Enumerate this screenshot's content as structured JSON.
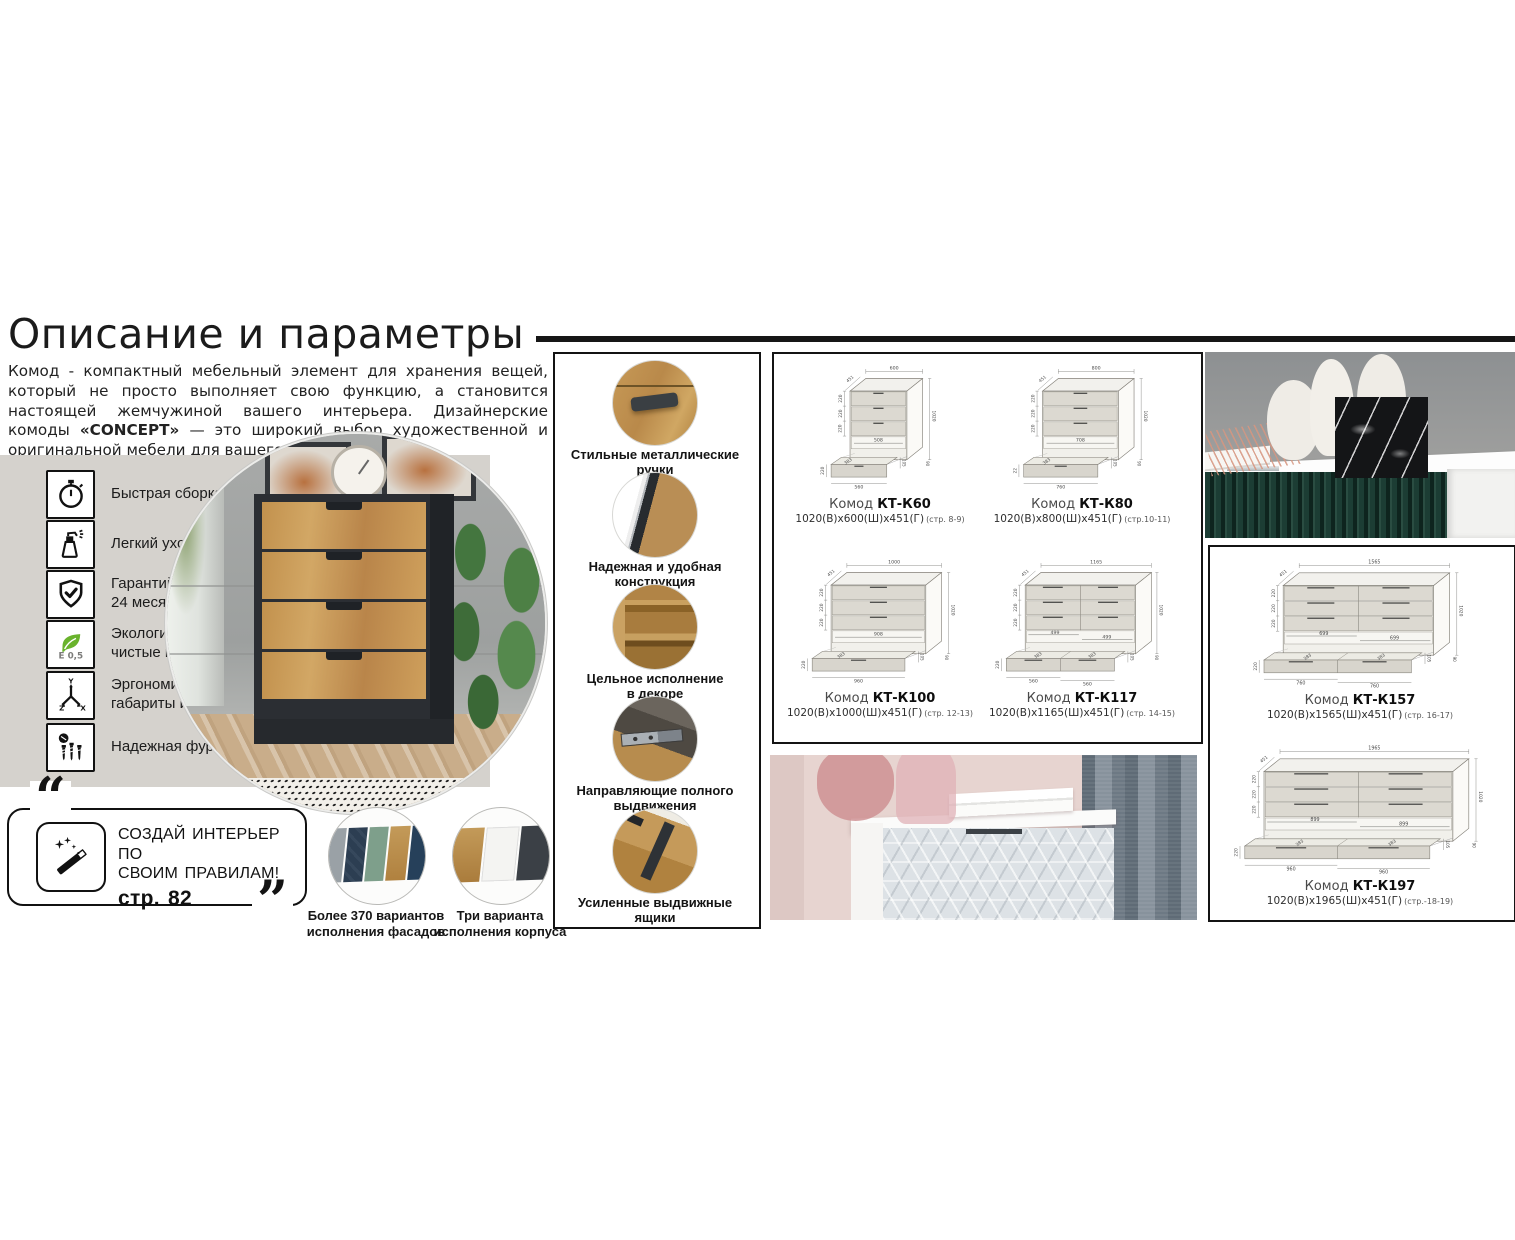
{
  "page": {
    "title": "Описание и параметры"
  },
  "intro": {
    "part1": "Комод - компактный мебельный элемент для хранения вещей, который не просто выполняет свою функцию, а становится настоящей жемчужиной вашего интерьера. Дизайнерские комоды ",
    "brand": "«CONCEPT»",
    "part2": " — это широкий выбор художественной и оригинальной мебели для вашего пространства."
  },
  "features": [
    {
      "icon": "stopwatch-icon",
      "line1": "Быстрая сборка",
      "line2": ""
    },
    {
      "icon": "spray-bottle-icon",
      "line1": "Легкий уход",
      "line2": ""
    },
    {
      "icon": "shield-check-icon",
      "line1": "Гарантийный срок",
      "line2": "24 месяца"
    },
    {
      "icon": "eco-leaf-icon",
      "icon_text": "E 0,5",
      "line1": "Экологически",
      "line2": "чистые материалы"
    },
    {
      "icon": "dimensions-axes-icon",
      "line1": "Эргономичные",
      "line2": "габариты изделий"
    },
    {
      "icon": "hardware-screws-icon",
      "line1": "Надежная фурнитура",
      "line2": ""
    }
  ],
  "promo": {
    "quote_open": "“",
    "quote_close": "”",
    "line1": "СОЗДАЙ ИНТЕРЬЕР ПО",
    "line2": "СВОИМ ПРАВИЛАМ!",
    "page_ref": "стр. 82"
  },
  "variants": [
    {
      "line1": "Более 370 вариантов",
      "line2": "исполнения фасадов",
      "colors": [
        "#9aa1a6",
        "#2c3e52",
        "#7e9f8b",
        "#b98d4f",
        "#26405a"
      ]
    },
    {
      "line1": "Три варианта",
      "line2": "исполнения корпуса",
      "colors": [
        "#bb8e4e",
        "#f4f4f2",
        "#3b4046"
      ]
    }
  ],
  "details": [
    {
      "line1": "Стильные металлические",
      "line2": "ручки"
    },
    {
      "line1": "Надежная и удобная",
      "line2": "конструкция"
    },
    {
      "line1": "Цельное исполнение",
      "line2": "в декоре"
    },
    {
      "line1": "Направляющие полного",
      "line2": "выдвижения"
    },
    {
      "line1": "Усиленные выдвижные",
      "line2": "ящики"
    }
  ],
  "drawings": {
    "items": [
      {
        "name_prefix": "Комод",
        "model": "КТ-К60",
        "dims": "1020(В)х600(Ш)х451(Г)",
        "pages": "(стр. 8-9)",
        "columns": 1,
        "top": "600",
        "depth": "451",
        "height": "1020",
        "rows": [
          "220",
          "220",
          "220"
        ],
        "inner": [
          "508"
        ],
        "bottom": [
          "560"
        ],
        "diag": "383",
        "lift": "105",
        "base": "90",
        "left": "220"
      },
      {
        "name_prefix": "Комод",
        "model": "КТ-К80",
        "dims": "1020(В)х800(Ш)х451(Г)",
        "pages": "(стр.10-11)",
        "columns": 1,
        "top": "800",
        "depth": "451",
        "height": "1020",
        "rows": [
          "220",
          "220",
          "220"
        ],
        "inner": [
          "708"
        ],
        "bottom": [
          "760"
        ],
        "diag": "383",
        "lift": "105",
        "base": "90",
        "left": "22"
      },
      {
        "name_prefix": "Комод",
        "model": "КТ-К100",
        "dims": "1020(В)х1000(Ш)х451(Г)",
        "pages": "(стр. 12-13)",
        "columns": 1,
        "top": "1000",
        "depth": "451",
        "height": "1020",
        "rows": [
          "220",
          "220",
          "220"
        ],
        "inner": [
          "908"
        ],
        "bottom": [
          "960"
        ],
        "diag": "383",
        "lift": "105",
        "base": "90",
        "left": "220"
      },
      {
        "name_prefix": "Комод",
        "model": "КТ-К117",
        "dims": "1020(В)х1165(Ш)х451(Г)",
        "pages": "(стр. 14-15)",
        "columns": 2,
        "top": "1165",
        "depth": "451",
        "height": "1020",
        "rows": [
          "220",
          "220",
          "220"
        ],
        "inner": [
          "499",
          "499"
        ],
        "bottom": [
          "560",
          "560"
        ],
        "diag": "383",
        "lift": "105",
        "base": "90",
        "left": "220"
      },
      {
        "name_prefix": "Комод",
        "model": "КТ-К157",
        "dims": "1020(В)х1565(Ш)х451(Г)",
        "pages": "(стр. 16-17)",
        "columns": 2,
        "top": "1565",
        "depth": "451",
        "height": "1020",
        "rows": [
          "220",
          "220",
          "220"
        ],
        "inner": [
          "699",
          "699"
        ],
        "bottom": [
          "760",
          "760"
        ],
        "diag": "383",
        "lift": "105",
        "base": "90",
        "left": "220"
      },
      {
        "name_prefix": "Комод",
        "model": "КТ-К197",
        "dims": "1020(В)х1965(Ш)х451(Г)",
        "pages": "(стр.-18-19)",
        "columns": 2,
        "top": "1965",
        "depth": "451",
        "height": "1020",
        "rows": [
          "220",
          "220",
          "220"
        ],
        "inner": [
          "899",
          "899"
        ],
        "bottom": [
          "960",
          "960"
        ],
        "diag": "383",
        "lift": "105",
        "base": "90",
        "left": "220"
      }
    ]
  },
  "colors": {
    "panel_grey": "#d5d2cd",
    "rule_black": "#161616",
    "eco_green": "#69b32c",
    "wood": "#c1924f",
    "dresser_dark": "#2b2e33",
    "green_cabinet": "#1c3d34"
  }
}
